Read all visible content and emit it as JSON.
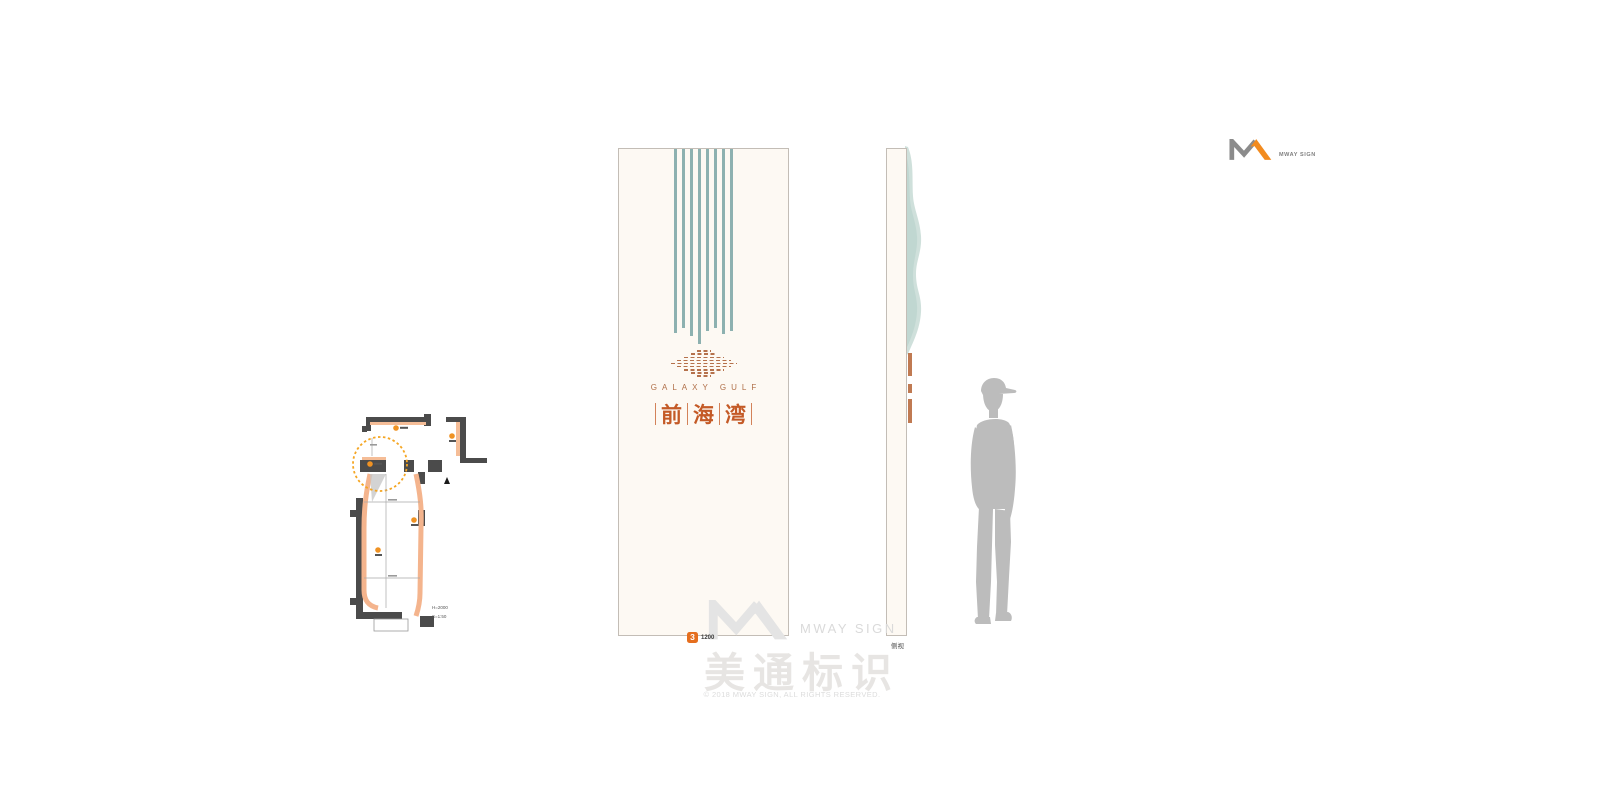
{
  "brand": {
    "wordmark": "MWAY SIGN"
  },
  "front_panel": {
    "brand_en": "GALAXY GULF",
    "cn_chars": [
      "前",
      "海",
      "湾"
    ],
    "stripe_heights": [
      184,
      179,
      187,
      195,
      182,
      179,
      185,
      182
    ],
    "emblem_row_widths": [
      14,
      26,
      40,
      54,
      66,
      54,
      40,
      26,
      14
    ]
  },
  "badge": {
    "number": "3",
    "width_label": "1200"
  },
  "side_view": {
    "label": "侧视"
  },
  "floor_plan": {
    "height_note": "H=2000",
    "scale_note": "S=1:50"
  },
  "watermark": {
    "wordmark": "MWAY SIGN",
    "cn": "美通标识"
  },
  "footer": {
    "copyright": "© 2018 MWAY SIGN, ALL RIGHTS RESERVED."
  },
  "colors": {
    "panel_cream": "#fdf9f3",
    "panel_border": "#c3bdb6",
    "stripe_teal": "#8db1b0",
    "blob_teal": "#cfe0db",
    "logo_copper": "#b5714b",
    "cn_orange": "#c45a26",
    "badge_orange": "#e56e1e",
    "plan_wall_gray": "#4b4b4b",
    "plan_salmon": "#f4b48d",
    "plan_accent_orange": "#ef9223",
    "silhouette_gray": "#bcbcbc",
    "watermark_gray": "#e0e0e0",
    "brand_gray": "#8b8b8b",
    "brand_orange": "#f28b1f"
  }
}
